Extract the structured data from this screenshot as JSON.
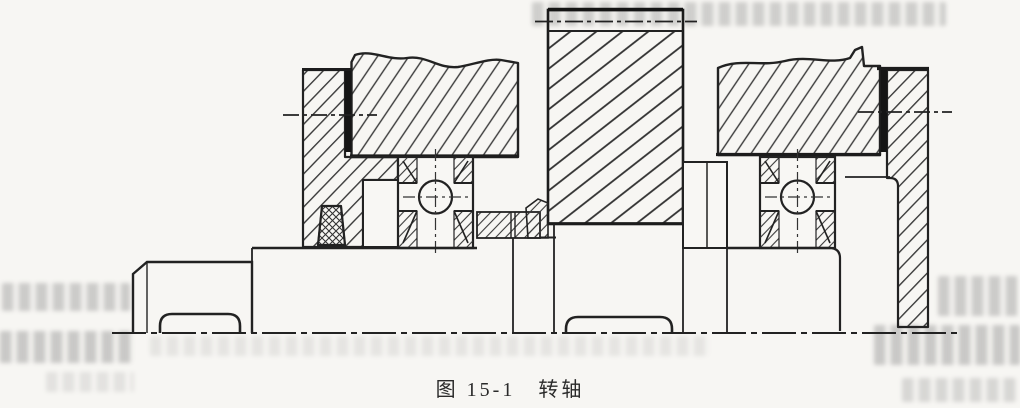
{
  "figure": {
    "caption": "图 15-1　转轴",
    "caption_number": "图 15-1",
    "caption_title": "转轴"
  },
  "palette": {
    "paper": "#f8f7f4",
    "ink": "#202020",
    "hatch": "#3a3a3a",
    "ghost_text": "#8f8f8f"
  }
}
